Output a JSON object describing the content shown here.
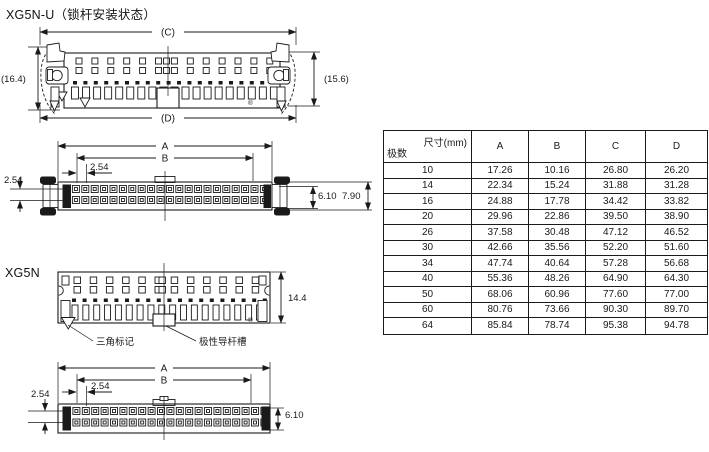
{
  "titles": {
    "main": "XG5N-U（锁杆安装状态）",
    "secondary": "XG5N"
  },
  "drawing1": {
    "dim_c": "(C)",
    "dim_d": "(D)",
    "dim_left": "(16.4)",
    "dim_right": "(15.6)",
    "registered": "®"
  },
  "drawing2": {
    "dim_a": "A",
    "dim_b": "B",
    "pitch_h": "2.54",
    "pitch_v": "2.54",
    "dim_inner": "6.10",
    "dim_outer": "7.90"
  },
  "drawing3": {
    "dim_height": "14.4",
    "callout_triangle": "三角标记",
    "callout_polarity": "极性导杆槽",
    "registered": "®"
  },
  "drawing4": {
    "dim_a": "A",
    "dim_b": "B",
    "pitch_h": "2.54",
    "pitch_v": "2.54",
    "dim_height": "6.10"
  },
  "table": {
    "header_dim": "尺寸(mm)",
    "header_poles": "极数",
    "columns": [
      "A",
      "B",
      "C",
      "D"
    ],
    "rows": [
      [
        "10",
        "17.26",
        "10.16",
        "26.80",
        "26.20"
      ],
      [
        "14",
        "22.34",
        "15.24",
        "31.88",
        "31.28"
      ],
      [
        "16",
        "24.88",
        "17.78",
        "34.42",
        "33.82"
      ],
      [
        "20",
        "29.96",
        "22.86",
        "39.50",
        "38.90"
      ],
      [
        "26",
        "37.58",
        "30.48",
        "47.12",
        "46.52"
      ],
      [
        "30",
        "42.66",
        "35.56",
        "52.20",
        "51.60"
      ],
      [
        "34",
        "47.74",
        "40.64",
        "57.28",
        "56.68"
      ],
      [
        "40",
        "55.36",
        "48.26",
        "64.90",
        "64.30"
      ],
      [
        "50",
        "68.06",
        "60.96",
        "77.60",
        "77.00"
      ],
      [
        "60",
        "80.76",
        "73.66",
        "90.30",
        "89.70"
      ],
      [
        "64",
        "85.84",
        "78.74",
        "95.38",
        "94.78"
      ]
    ]
  }
}
